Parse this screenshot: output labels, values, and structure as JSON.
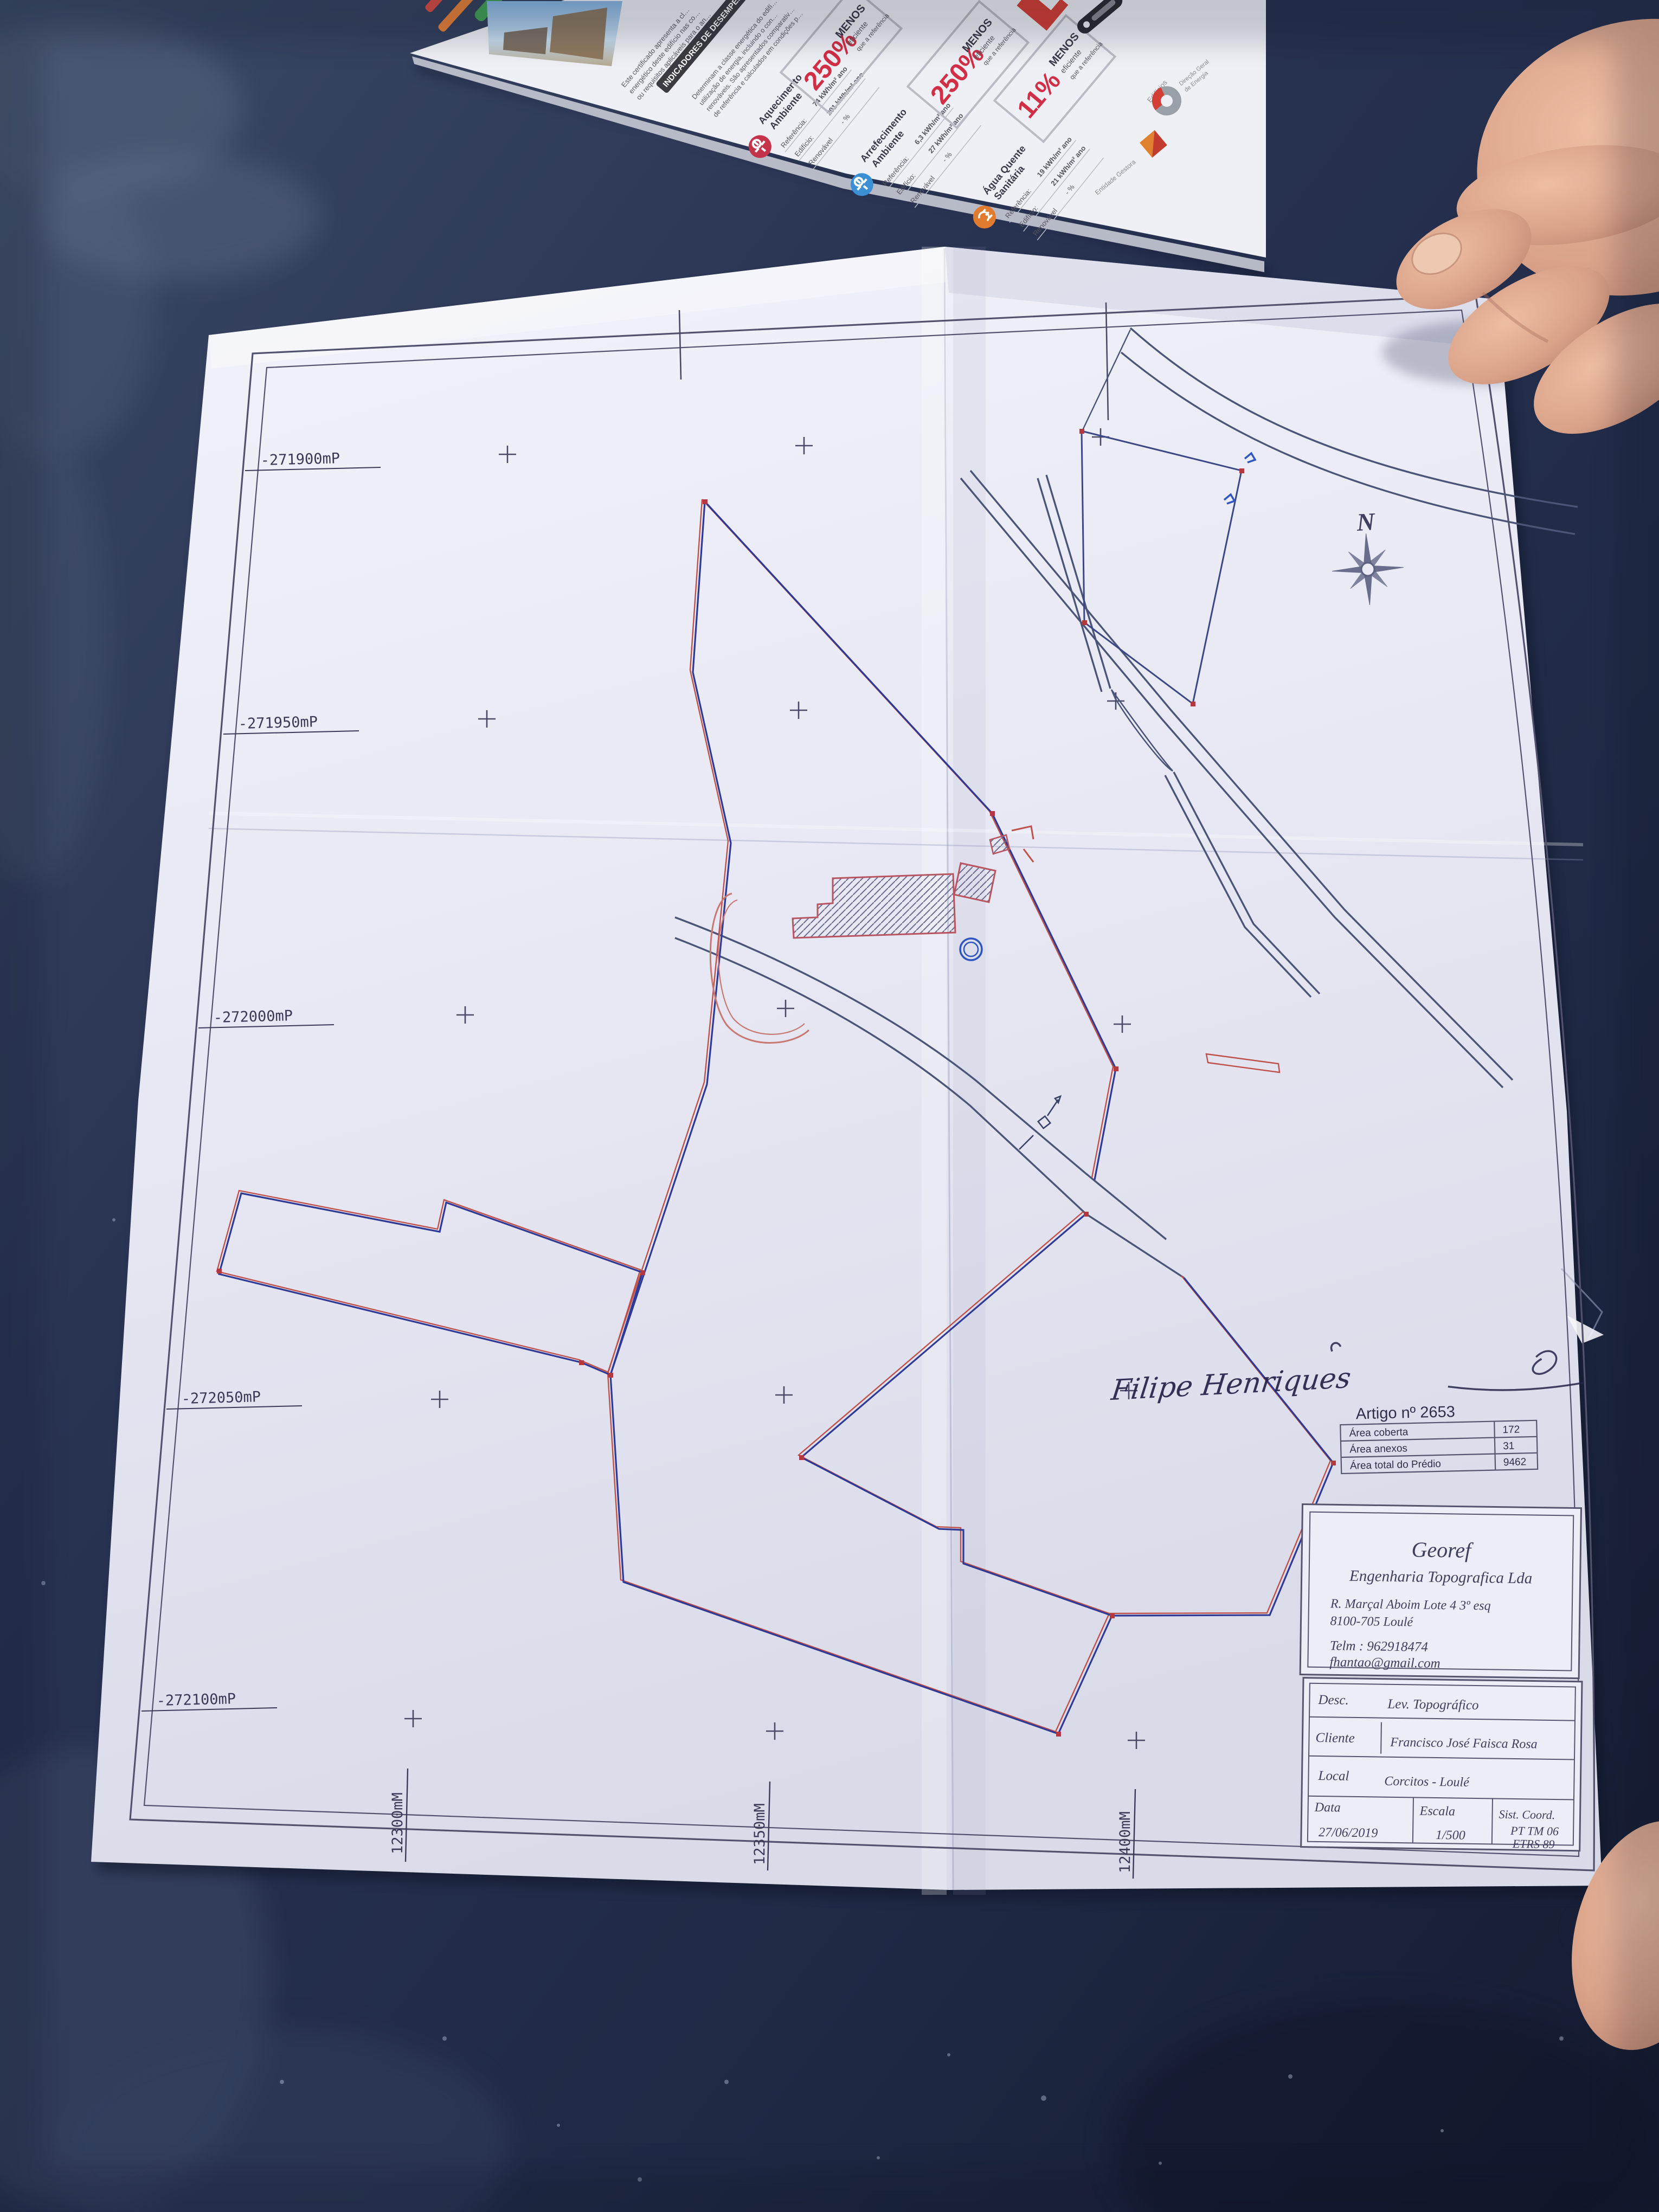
{
  "colors": {
    "table": "#26304c",
    "paper": "#e9eaf4",
    "parcel_blue": "#2e3a96",
    "parcel_red": "#c0504a",
    "road_grey": "#4a5578",
    "badge_red": "#c5334a",
    "icon_blue": "#3b8fd4",
    "icon_orange": "#e07b2f"
  },
  "leaflet": {
    "para1": [
      "Este certificado apresenta a cl…",
      "energético deste edifício nas co…",
      "ou requisitos aplicáveis para o an…"
    ],
    "banner": "INDICADORES DE DESEMPENHO",
    "para2": [
      "Determinam a classe energética do edifí…",
      "utilização de energia, incluindo o con…",
      "renováveis. São apresentados comparativ…",
      "de referência e calculados em condições p…"
    ],
    "sections": [
      {
        "name1": "Aquecimento",
        "name2": "Ambiente",
        "rows": [
          [
            "Referência:",
            "74 kWh/m² ano"
          ],
          [
            "Edifício:",
            "291 kWh/m² ano"
          ],
          [
            "Renovável",
            "- %"
          ]
        ],
        "badge": "250%"
      },
      {
        "name1": "Arrefecimento",
        "name2": "Ambiente",
        "rows": [
          [
            "Referência:",
            "6,3 kWh/m² ano"
          ],
          [
            "Edifício:",
            "27 kWh/m² ano"
          ],
          [
            "Renovável",
            "- %"
          ]
        ],
        "badge": "250%"
      },
      {
        "name1": "Água Quente",
        "name2": "Sanitária",
        "rows": [
          [
            "Referência:",
            "19 kWh/m² ano"
          ],
          [
            "Edifício:",
            "21 kWh/m² ano"
          ],
          [
            "Renovável",
            "- %"
          ]
        ],
        "badge": "11%"
      }
    ],
    "badge_sub": [
      "MENOS",
      "eficiente",
      "que a referência"
    ],
    "logos": {
      "edificios": "Edifícios",
      "dgeg1": "Direção Geral",
      "dgeg2": "de Energia",
      "gestora": "Entidade Gestora"
    }
  },
  "map": {
    "coords_left": [
      "-271900mP",
      "-271950mP",
      "-272000mP",
      "-272050mP",
      "-272100mP"
    ],
    "coords_bottom": [
      "12300mM",
      "12350mM",
      "12400mM"
    ],
    "north": "N",
    "signature": "Filipe Henriques",
    "artigo": {
      "title": "Artigo nº 2653",
      "rows": [
        {
          "label": "Área coberta",
          "value": "172"
        },
        {
          "label": "Área anexos",
          "value": "31"
        },
        {
          "label": "Área total do Prédio",
          "value": "9462"
        }
      ]
    },
    "title_block": {
      "company": "Georef",
      "subtitle": "Engenharia Topografica Lda",
      "address1": "R. Marçal Aboim Lote 4 3º esq",
      "address2": "8100-705 Loulé",
      "phone": "Telm : 962918474",
      "email": "fhantao@gmail.com",
      "desc_label": "Desc.",
      "desc_value": "Lev. Topográfico",
      "cliente_label": "Cliente",
      "cliente_value": "Francisco José Faisca Rosa",
      "local_label": "Local",
      "local_value": "Corcitos - Loulé",
      "data_label": "Data",
      "data_value": "27/06/2019",
      "escala_label": "Escala",
      "escala_value": "1/500",
      "sist_label": "Sist. Coord.",
      "sist_value1": "PT TM 06",
      "sist_value2": "ETRS 89"
    }
  }
}
